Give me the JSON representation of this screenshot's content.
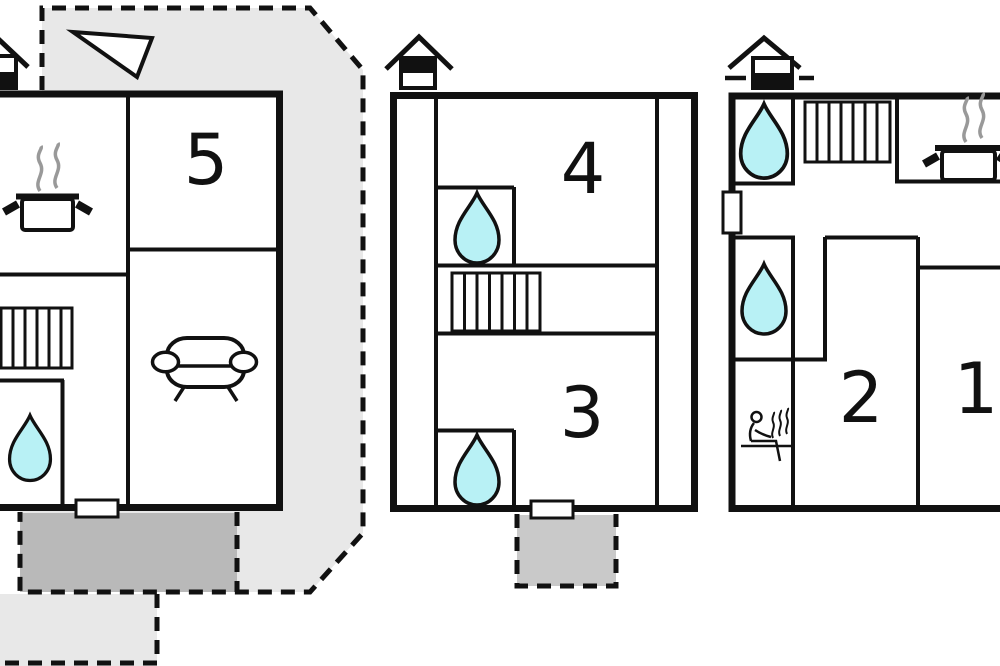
{
  "plan": {
    "type": "floor-plan",
    "room_labels": [
      {
        "id": "room-5",
        "label": "5"
      },
      {
        "id": "room-4",
        "label": "4"
      },
      {
        "id": "room-3",
        "label": "3"
      },
      {
        "id": "room-2",
        "label": "2"
      },
      {
        "id": "room-1",
        "label": "1"
      }
    ],
    "units": [
      {
        "name": "building-left",
        "rooms": [
          "5"
        ],
        "features": [
          "chimney",
          "north-arrow",
          "kitchen-pot",
          "stairs",
          "bathroom-water-drop",
          "sofa",
          "door",
          "dashed-terrace",
          "dark-patio"
        ]
      },
      {
        "name": "building-middle",
        "rooms": [
          "4",
          "3"
        ],
        "features": [
          "chimney",
          "bathroom-water-drop",
          "bathroom-water-drop",
          "stairs",
          "door",
          "dashed-patio"
        ]
      },
      {
        "name": "building-right",
        "rooms": [
          "2",
          "1"
        ],
        "features": [
          "chimney",
          "bathroom-water-drop",
          "bathroom-water-drop",
          "stairs",
          "kitchen-pot",
          "sauna",
          "door"
        ]
      }
    ],
    "icon_legend": {
      "water-drop": "bathroom / water point",
      "bar-hatch-rect": "stairs",
      "house-with-band": "chimney / vent",
      "pot-with-steam": "kitchen",
      "sofa": "living room",
      "person-with-steam": "sauna",
      "white-triangle": "north-arrow",
      "white-gap-in-wall": "door",
      "gray-dashed-area": "terrace / patio"
    },
    "counts": {
      "water_drops": 5,
      "stairs": 3,
      "chimneys": 3,
      "kitchen_pots": 2,
      "sofas": 1,
      "saunas": 1,
      "doors": 3
    },
    "colors": {
      "wall": "#111111",
      "terrace_light": "#e8e8e8",
      "terrace_dark": "#b9b9b9",
      "patio_mid": "#c9c9c9",
      "water": "#b8f1f5",
      "steam": "#999999",
      "background": "#ffffff"
    }
  }
}
